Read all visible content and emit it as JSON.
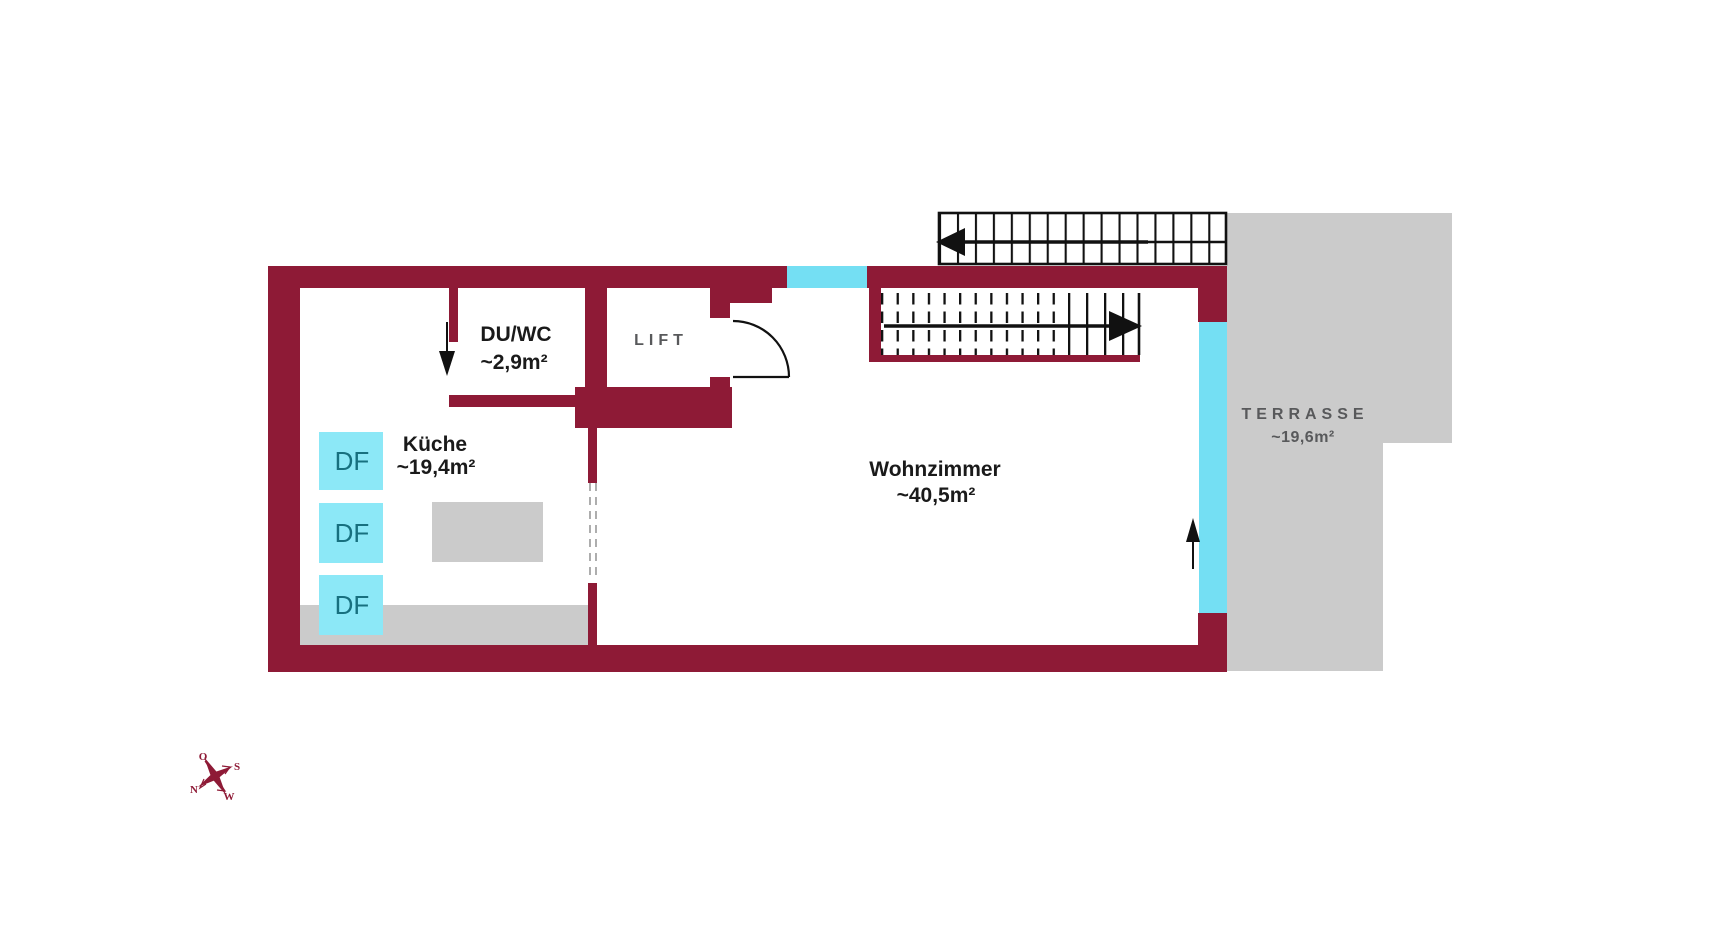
{
  "colors": {
    "wall": "#8e1a36",
    "window": "#74dff3",
    "roofwin": "#8ce8f7",
    "dftext": "#17707f",
    "surface": "#cbcbcb",
    "ink": "#1a1a1a",
    "muted": "#58595b"
  },
  "rooms": {
    "duwc": {
      "name": "DU/WC",
      "area": "~2,9m²"
    },
    "kueche": {
      "name": "Küche",
      "area": "~19,4m²"
    },
    "lift": {
      "name": "LIFT"
    },
    "wohnzimmer": {
      "name": "Wohnzimmer",
      "area": "~40,5m²"
    },
    "terrasse": {
      "name": "TERRASSE",
      "area": "~19,6m²"
    }
  },
  "roof_window": {
    "label": "DF"
  },
  "compass": {
    "east": "O",
    "south": "S",
    "north": "N",
    "west": "W"
  }
}
